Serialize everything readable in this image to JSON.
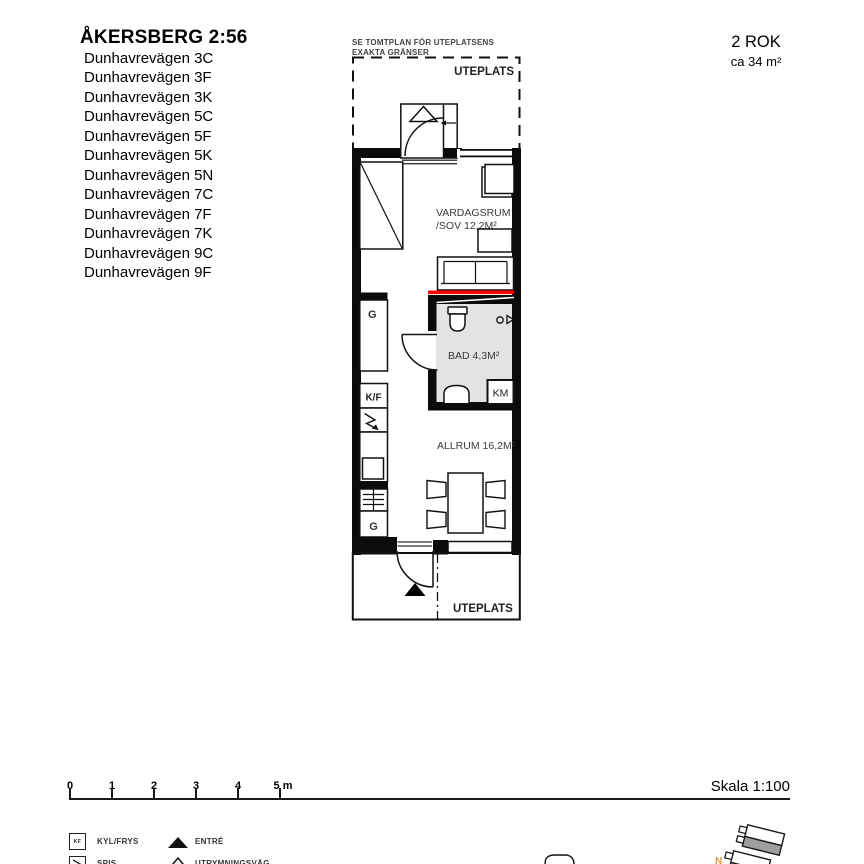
{
  "header": {
    "title": "ÅKERSBERG 2:56",
    "addresses": [
      "Dunhavrevägen 3C",
      "Dunhavrevägen 3F",
      "Dunhavrevägen 3K",
      "Dunhavrevägen 5C",
      "Dunhavrevägen 5F",
      "Dunhavrevägen 5K",
      "Dunhavrevägen 5N",
      "Dunhavrevägen 7C",
      "Dunhavrevägen 7F",
      "Dunhavrevägen 7K",
      "Dunhavrevägen 9C",
      "Dunhavrevägen 9F"
    ],
    "apartment_type": "2 ROK",
    "apartment_area": "ca 34 m²"
  },
  "plan": {
    "site_note_line1": "SE TOMTPLAN FÖR UTEPLATSENS",
    "site_note_line2": "EXAKTA GRÄNSER",
    "uteplats_top_label": "UTEPLATS",
    "uteplats_bottom_label": "UTEPLATS",
    "vardagsrum_line1": "VARDAGSRUM",
    "vardagsrum_line2": "/SOV 12,2M²",
    "bad_label": "BAD 4,3M²",
    "allrum_label": "ALLRUM 16,2M²",
    "km_label": "KM",
    "closet_upper_label": "G",
    "fridge_label": "K/F",
    "closet_lower_label": "G"
  },
  "scale_bar": {
    "ticks": [
      "0",
      "1",
      "2",
      "3",
      "4",
      "5 m"
    ],
    "scale_label": "Skala 1:100"
  },
  "legend": {
    "kf_icon_text": "KF",
    "items": [
      {
        "label": "KYL/FRYS"
      },
      {
        "label": "SPIS"
      },
      {
        "label": "ENTRÉ"
      },
      {
        "label": "UTRYMNINGSVÄG"
      }
    ]
  },
  "site_plan": {
    "north_label": "N"
  },
  "colors": {
    "escape_route_red": "#ff0000",
    "bathroom_fill": "#e3e3e3",
    "building_gray": "#9e9e9e",
    "north_orange": "#d89a44"
  }
}
